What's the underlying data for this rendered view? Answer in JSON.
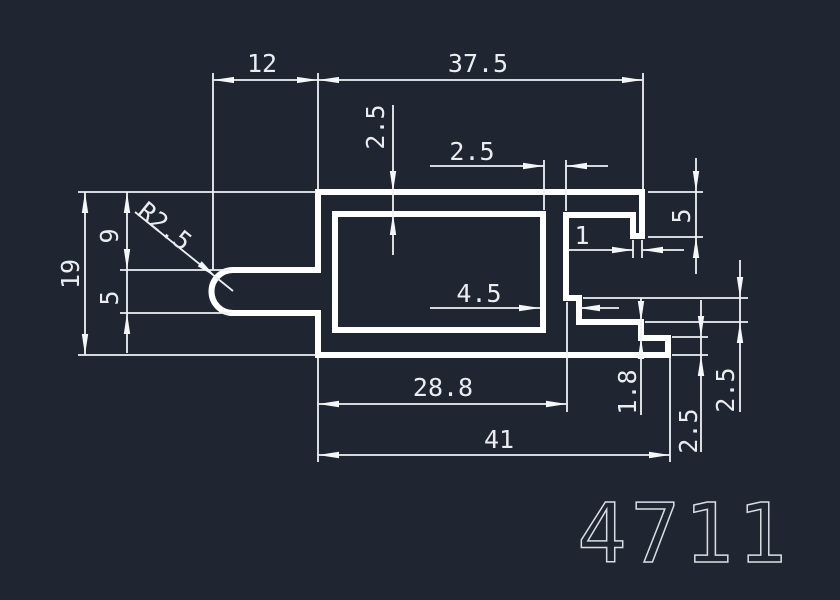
{
  "title": {
    "drawing_number": "4711"
  },
  "colors": {
    "background": "#202631",
    "profile_line": "#ffffff",
    "dimension_line": "#eef1f4",
    "text": "#e9edf0"
  },
  "drawing": {
    "outer_path": "M318,192 L642,192 L642,236 L633,236 L633,215 L566,215 L566,298 L579,298 L579,322 L641,322 L641,338 L668,338 L668,355 L318,355 L318,313 L233,313 A21.5,21.5 0 0 1 233,270 L318,270 Z",
    "cavity_path": "M335,214 L543,214 L543,330 L335,330 Z"
  },
  "dimensions": {
    "top_left_width": "12",
    "top_right_width": "37.5",
    "wall_top": "2.5",
    "wall_right": "2.5",
    "hook_wall": "1",
    "hook_depth": "5",
    "height_total": "19",
    "height_upper": "9",
    "slot_height": "5",
    "slot_radius": "R2.5",
    "groove_width": "4.5",
    "width_inner": "28.8",
    "width_total": "41",
    "lip_step": "1.8",
    "step_height": "2.5",
    "lip_height": "2.5"
  }
}
